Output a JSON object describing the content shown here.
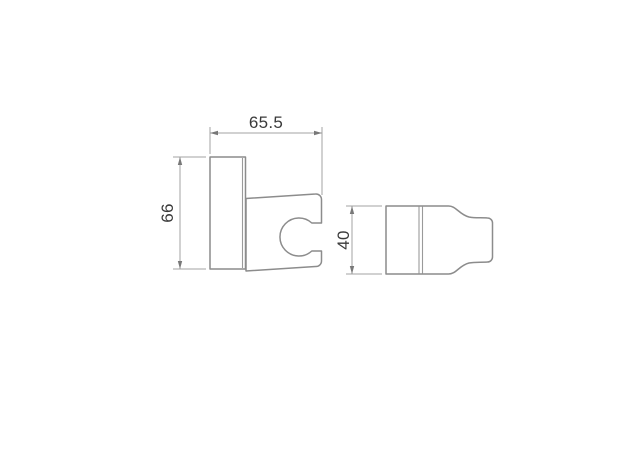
{
  "colors": {
    "background": "#ffffff",
    "outline": "#8c8c8c",
    "dimension_line": "#a3a3a3",
    "arrow": "#787878",
    "text": "#3a3a3a"
  },
  "dimensions": {
    "width": "65.5",
    "height": "66",
    "depth": "40"
  }
}
